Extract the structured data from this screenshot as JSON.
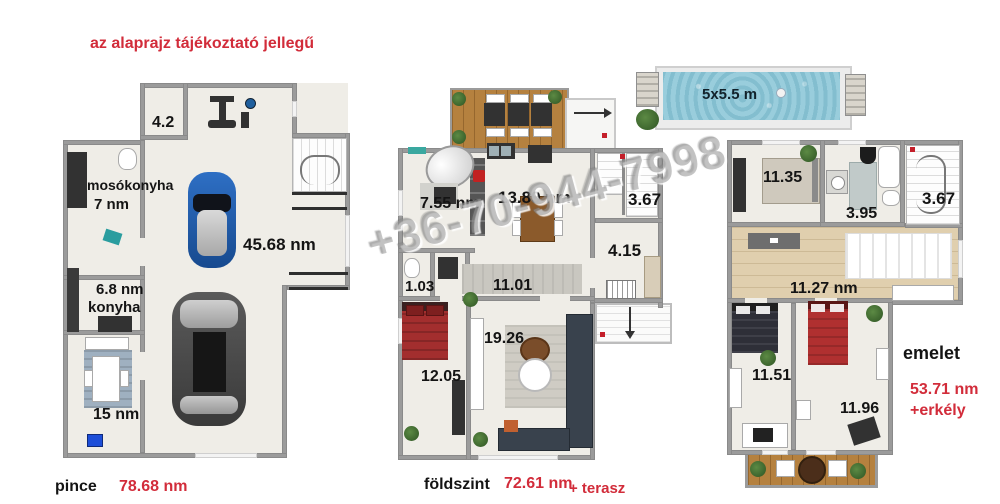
{
  "disclaimer": "az alaprajz tájékoztató jellegű",
  "watermark": "+36-70-944-7998",
  "pool": {
    "label": "5x5.5 m"
  },
  "pince": {
    "label": "pince",
    "area": "78.68 nm",
    "rooms": {
      "storage": "4.2",
      "laundry_name": "mosókonyha",
      "laundry_area": "7 nm",
      "garage": "45.68 nm",
      "kitchen_area": "6.8 nm",
      "kitchen_name": "konyha",
      "hobby": "15 nm"
    }
  },
  "foldszint": {
    "label": "földszint",
    "area": "72.61 nm",
    "suffix": "+ terasz",
    "rooms": {
      "room755": "7.55 nm",
      "kitchen": "13.89 nm",
      "stairs": "3.67",
      "hall": "4.15",
      "corridor": "11.01",
      "wc": "1.03",
      "bedroom": "12.05",
      "living": "19.26"
    }
  },
  "emelet": {
    "label": "emelet",
    "area": "53.71 nm",
    "suffix": "+erkély",
    "rooms": {
      "room1135": "11.35",
      "bath": "3.95",
      "stairs": "3.67",
      "corridor": "11.27 nm",
      "bedroom1": "11.51",
      "bedroom2": "11.96"
    }
  },
  "colors": {
    "accent_red": "#d22c3a",
    "wall_gray": "#9b9b9b",
    "floor_beige": "#efede7",
    "wood_brown": "#b5813f",
    "hall_wood": "#e0cfae",
    "pool_water": "#8ec7d6"
  }
}
